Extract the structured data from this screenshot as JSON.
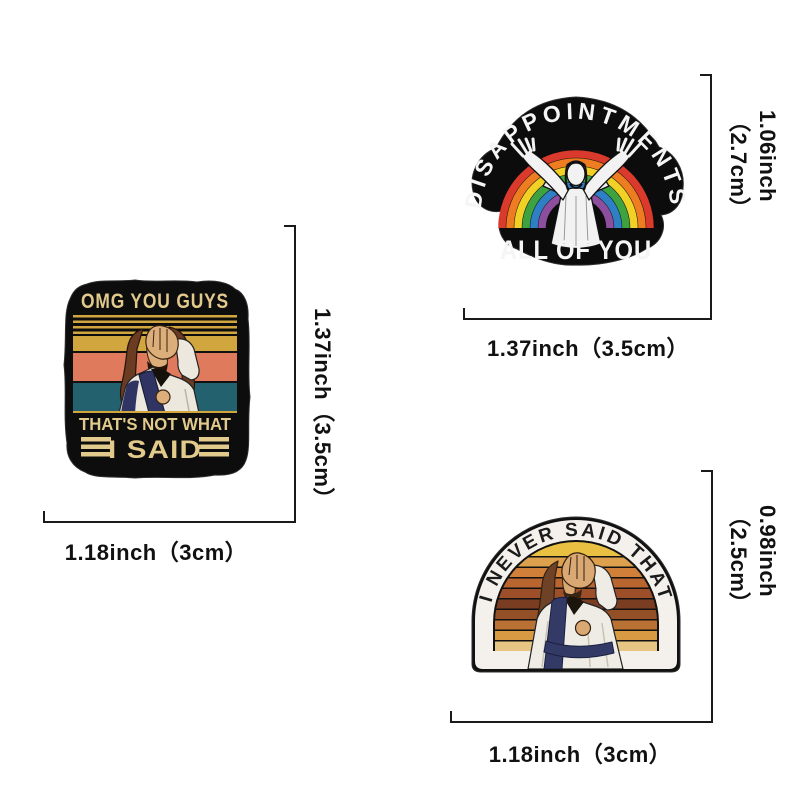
{
  "page": {
    "background": "#ffffff",
    "dimension_line_color": "#1a1a1a"
  },
  "pins": {
    "omg": {
      "name": "omg-you-guys-pin",
      "line1": "OMG YOU GUYS",
      "line2": "THAT'S NOT WHAT",
      "line3": "I SAID",
      "height_label": "1.37inch（3.5cm）",
      "width_label": "1.18inch（3cm）",
      "colors": {
        "base": "#0d0d0d",
        "gold": "#e2c98c",
        "stripe_gold": "#d2a63e",
        "stripe_salmon": "#e07a5c",
        "stripe_teal": "#23616f",
        "hair": "#6b3b22",
        "skin": "#dcae7a",
        "robe": "#ece8dd",
        "sash": "#2f3463"
      }
    },
    "disappointments": {
      "name": "disappointments-pin",
      "arc_text": "DISAPPOINTMENTS",
      "bottom_text": "ALL OF YOU",
      "height_label": "1.06inch（2.7cm）",
      "width_label": "1.37inch（3.5cm）",
      "colors": {
        "base": "#0c0c0c",
        "text": "#f5f5f5",
        "figure": "#f2f2f2",
        "rainbow": [
          "#d93a2b",
          "#ee7d22",
          "#f2d127",
          "#3da23f",
          "#2f7fc4",
          "#8e4e9e"
        ]
      }
    },
    "never_said": {
      "name": "i-never-said-that-pin",
      "arc_text": "I NEVER SAID THAT",
      "height_label": "0.98inch（2.5cm）",
      "width_label": "1.18inch（3cm）",
      "colors": {
        "rim": "#111111",
        "band": "#f4f1ec",
        "text": "#1b1b1b",
        "stripes": [
          "#eac043",
          "#dda14d",
          "#d08038",
          "#b9652f",
          "#9c4f29",
          "#7a3d22",
          "#935026",
          "#b97134",
          "#d89a43",
          "#e7c683"
        ],
        "hair": "#6d4226",
        "skin": "#d9a873",
        "robe": "#efece6",
        "sash": "#333a66"
      }
    }
  }
}
